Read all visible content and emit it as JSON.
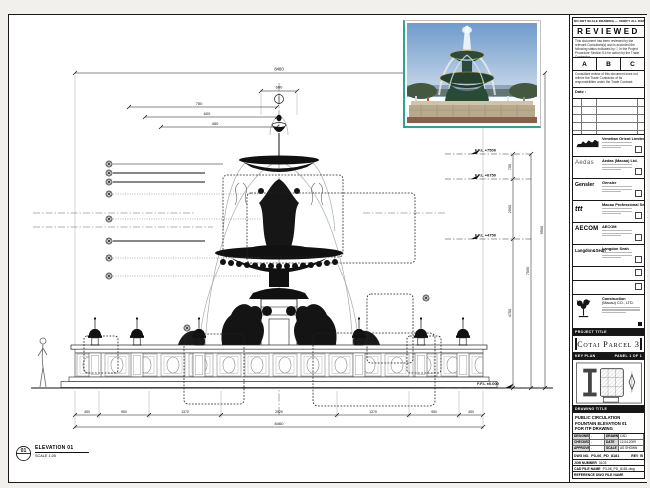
{
  "stamp": {
    "header_note": "DO NOT SCALE DRAWING — VERIFY ALL DIMENSIONS ON SITE",
    "title": "REVIEWED",
    "para1": "This document has been reviewed by the relevant Consultant(s) and is accorded the following status indicated by ☐ in the Project Procedure Section 5.4 for action by the Trade Contractor.",
    "options": [
      "A",
      "B",
      "C"
    ],
    "para2": "Consultant review of this document does not relieve the Trade Contractor of its responsibilities under the Trade Contract.",
    "date_label": "Date :",
    "rev_headers": [
      "REV",
      "DATE",
      "DESCRIPTION"
    ]
  },
  "consultants": [
    {
      "name": "Venetian Orient Limited",
      "logo": ""
    },
    {
      "name": "Aedas (Macau) Ltd.",
      "logo": "Aedas"
    },
    {
      "name": "Gensler",
      "logo": "Gensler"
    },
    {
      "name": "Macau Professional Services Ltd.",
      "logo": "ttt"
    },
    {
      "name": "AECOM",
      "logo": "AECOM"
    },
    {
      "name": "Langdon Seah",
      "logo": "Langdon&Seah"
    }
  ],
  "contractor": {
    "line1": "Construction",
    "line2": "(Macau) CO., LTD."
  },
  "project": {
    "bar": "PROJECT TITLE",
    "name": "Cotai Parcel 3"
  },
  "keyplan": {
    "bar_left": "KEY PLAN",
    "bar_right": "PANEL 1 OF 1"
  },
  "title_block": {
    "bar": "DRAWING TITLE",
    "line1": "PUBLIC CIRCULATION",
    "line2": "FOUNTAIN ELEVATION 01",
    "line3": "FOR ITP DRAWING",
    "designed_label": "DESIGNED",
    "designed": "-",
    "drawn_label": "DRAWN",
    "drawn": "CAD",
    "checked_label": "CHECKED",
    "checked": "-",
    "date_label": "DATE",
    "date": "12.04.2009",
    "approved_label": "APPROVED",
    "approved": "-",
    "scale_label": "SCALE",
    "scale": "AS SHOWN",
    "dwg_label": "DWG NO.",
    "dwg_no": "P3-06_PD_8181",
    "rev_label": "REV",
    "rev": "B",
    "job_label": "JOB NUMBER",
    "job": "3103",
    "cad_label": "CAD FILE NAME",
    "cad": "P3-06_PD_8181.dwg",
    "ref_label": "REFERENCE DWG FILE NAME"
  },
  "elevation_key": {
    "num": "01",
    "title": "ELEVATION 01",
    "scale": "SCALE 1:25"
  },
  "drawing": {
    "levels": [
      {
        "label": "F.F.L +7500"
      },
      {
        "label": "F.F.L +6750"
      },
      {
        "label": "F.F.L +4750"
      },
      {
        "label": "F.F.L ±0.000"
      }
    ],
    "dims_vertical": [
      "750",
      "2000",
      "4750",
      "7500",
      "9500"
    ],
    "dim_top_total": "8460",
    "dim_finial": "600",
    "dims_left": [
      "750",
      "600",
      "450"
    ],
    "dims_bottom": [
      "450",
      "950",
      "1370",
      "2920",
      "1370",
      "950",
      "450"
    ],
    "dim_bottom_total": "8460"
  }
}
